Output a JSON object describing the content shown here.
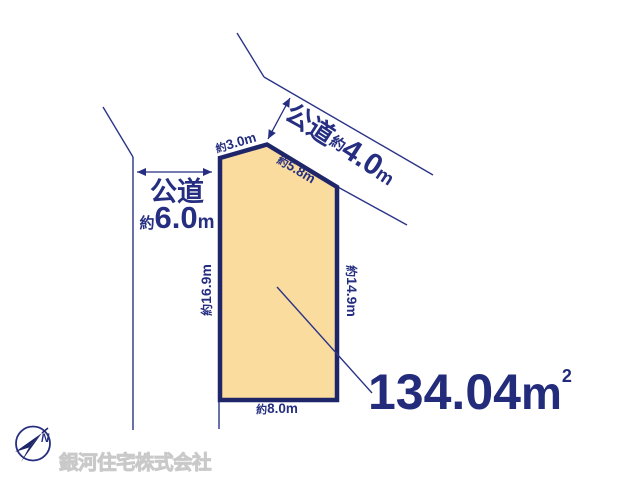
{
  "diagram_type": "land-plot-plan",
  "roads": {
    "left": {
      "name": "公道",
      "width_about": "約",
      "width_value": "6.0",
      "width_unit": "m"
    },
    "top": {
      "name": "公道",
      "width_about": "約",
      "width_value": "4.0",
      "width_unit": "m"
    }
  },
  "plot": {
    "area": {
      "value": "134.04",
      "unit": "m",
      "superscript": "2"
    },
    "dimensions": {
      "top": {
        "about": "約",
        "value": "3.0m"
      },
      "upper_right": {
        "about": "約",
        "value": "5.8m"
      },
      "left": {
        "about": "約",
        "value": "16.9m"
      },
      "right": {
        "about": "約",
        "value": "14.9m"
      },
      "bottom": {
        "about": "約",
        "value": "8.0m"
      }
    }
  },
  "compass": {
    "north_label": "N"
  },
  "watermark": {
    "company": "銀河住宅株式会社"
  },
  "colors": {
    "parcel_fill": "#FADC9F",
    "parcel_border": "#1F2569",
    "line_navy": "#2B3488",
    "text_navy": "#252E80",
    "watermark_gray": "#c9c9c9"
  }
}
